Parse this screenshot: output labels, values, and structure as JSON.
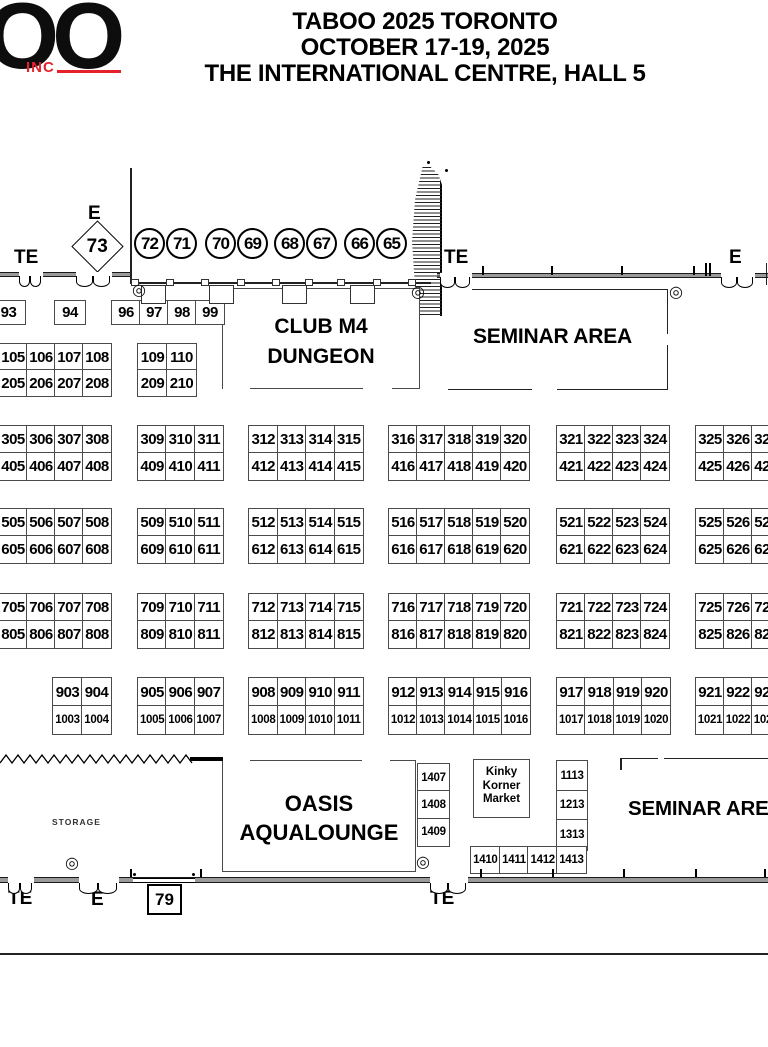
{
  "header": {
    "logo_main": "OO",
    "logo_sub": "INC",
    "title_line1": "TABOO 2025 TORONTO",
    "title_line2": "OCTOBER 17-19, 2025",
    "title_line3": "THE INTERNATIONAL CENTRE, HALL 5"
  },
  "colors": {
    "logo_red": "#e5222b",
    "wall_gray": "#9a9a9a"
  },
  "plan": {
    "entrance_labels": {
      "top_left_te": "TE",
      "top_left_e": "E",
      "top_right_te": "TE",
      "top_right_e": "E",
      "bottom_left_te": "TE",
      "bottom_e": "E",
      "bottom_right_te": "TE"
    },
    "diamond_booth": "73",
    "booth_79": "79",
    "circle_booths": [
      "72",
      "71",
      "70",
      "69",
      "68",
      "67",
      "66",
      "65"
    ],
    "areas": {
      "club_line1": "CLUB M4",
      "club_line2": "DUNGEON",
      "seminar_top": "SEMINAR AREA",
      "seminar_bottom": "SEMINAR AREA",
      "oasis_line1": "OASIS",
      "oasis_line2": "AQUALOUNGE",
      "kinky_line1": "Kinky",
      "kinky_line2": "Korner",
      "kinky_line3": "Market",
      "storage": "STORAGE"
    },
    "blocks": [
      {
        "x": -9,
        "y": 300,
        "cw": 33,
        "rh": 23,
        "rows": [
          [
            "93"
          ]
        ]
      },
      {
        "x": 54,
        "y": 300,
        "cw": 30,
        "rh": 23,
        "rows": [
          [
            "94"
          ]
        ]
      },
      {
        "x": 111,
        "y": 300,
        "cw": 28,
        "rh": 23,
        "rows": [
          [
            "96",
            "97",
            "98",
            "99"
          ]
        ]
      },
      {
        "x": -2,
        "y": 343,
        "cw": 28,
        "rh": 26,
        "rows": [
          [
            "105",
            "106",
            "107",
            "108"
          ],
          [
            "205",
            "206",
            "207",
            "208"
          ]
        ]
      },
      {
        "x": 137,
        "y": 343,
        "cw": 29,
        "rh": 26,
        "rows": [
          [
            "109",
            "110"
          ],
          [
            "209",
            "210"
          ]
        ]
      },
      {
        "x": -2,
        "y": 425,
        "cw": 28,
        "rh": 27,
        "rows": [
          [
            "305",
            "306",
            "307",
            "308"
          ],
          [
            "405",
            "406",
            "407",
            "408"
          ]
        ]
      },
      {
        "x": 137,
        "y": 425,
        "cw": 28.3,
        "rh": 27,
        "rows": [
          [
            "309",
            "310",
            "311"
          ],
          [
            "409",
            "410",
            "411"
          ]
        ]
      },
      {
        "x": 248,
        "y": 425,
        "cw": 28.5,
        "rh": 27,
        "rows": [
          [
            "312",
            "313",
            "314",
            "315"
          ],
          [
            "412",
            "413",
            "414",
            "415"
          ]
        ]
      },
      {
        "x": 388,
        "y": 425,
        "cw": 28,
        "rh": 27,
        "rows": [
          [
            "316",
            "317",
            "318",
            "319",
            "320"
          ],
          [
            "416",
            "417",
            "418",
            "419",
            "420"
          ]
        ]
      },
      {
        "x": 556,
        "y": 425,
        "cw": 28,
        "rh": 27,
        "rows": [
          [
            "321",
            "322",
            "323",
            "324"
          ],
          [
            "421",
            "422",
            "423",
            "424"
          ]
        ]
      },
      {
        "x": 695,
        "y": 425,
        "cw": 28,
        "rh": 27,
        "rows": [
          [
            "325",
            "326",
            "327"
          ],
          [
            "425",
            "426",
            "427"
          ]
        ]
      },
      {
        "x": -2,
        "y": 508,
        "cw": 28,
        "rh": 27,
        "rows": [
          [
            "505",
            "506",
            "507",
            "508"
          ],
          [
            "605",
            "606",
            "607",
            "608"
          ]
        ]
      },
      {
        "x": 137,
        "y": 508,
        "cw": 28.3,
        "rh": 27,
        "rows": [
          [
            "509",
            "510",
            "511"
          ],
          [
            "609",
            "610",
            "611"
          ]
        ]
      },
      {
        "x": 248,
        "y": 508,
        "cw": 28.5,
        "rh": 27,
        "rows": [
          [
            "512",
            "513",
            "514",
            "515"
          ],
          [
            "612",
            "613",
            "614",
            "615"
          ]
        ]
      },
      {
        "x": 388,
        "y": 508,
        "cw": 28,
        "rh": 27,
        "rows": [
          [
            "516",
            "517",
            "518",
            "519",
            "520"
          ],
          [
            "616",
            "617",
            "618",
            "619",
            "620"
          ]
        ]
      },
      {
        "x": 556,
        "y": 508,
        "cw": 28,
        "rh": 27,
        "rows": [
          [
            "521",
            "522",
            "523",
            "524"
          ],
          [
            "621",
            "622",
            "623",
            "624"
          ]
        ]
      },
      {
        "x": 695,
        "y": 508,
        "cw": 28,
        "rh": 27,
        "rows": [
          [
            "525",
            "526",
            "527"
          ],
          [
            "625",
            "626",
            "627"
          ]
        ]
      },
      {
        "x": -2,
        "y": 593,
        "cw": 28,
        "rh": 27,
        "rows": [
          [
            "705",
            "706",
            "707",
            "708"
          ],
          [
            "805",
            "806",
            "807",
            "808"
          ]
        ]
      },
      {
        "x": 137,
        "y": 593,
        "cw": 28.3,
        "rh": 27,
        "rows": [
          [
            "709",
            "710",
            "711"
          ],
          [
            "809",
            "810",
            "811"
          ]
        ]
      },
      {
        "x": 248,
        "y": 593,
        "cw": 28.5,
        "rh": 27,
        "rows": [
          [
            "712",
            "713",
            "714",
            "715"
          ],
          [
            "812",
            "813",
            "814",
            "815"
          ]
        ]
      },
      {
        "x": 388,
        "y": 593,
        "cw": 28,
        "rh": 27,
        "rows": [
          [
            "716",
            "717",
            "718",
            "719",
            "720"
          ],
          [
            "816",
            "817",
            "818",
            "819",
            "820"
          ]
        ]
      },
      {
        "x": 556,
        "y": 593,
        "cw": 28,
        "rh": 27,
        "rows": [
          [
            "721",
            "722",
            "723",
            "724"
          ],
          [
            "821",
            "822",
            "823",
            "824"
          ]
        ]
      },
      {
        "x": 695,
        "y": 593,
        "cw": 28,
        "rh": 27,
        "rows": [
          [
            "725",
            "726",
            "727"
          ],
          [
            "825",
            "826",
            "827"
          ]
        ]
      },
      {
        "x": 52,
        "y": 677,
        "cw": 29,
        "rh": 28,
        "rows": [
          [
            "903",
            "904"
          ],
          [
            "1003",
            "1004"
          ]
        ]
      },
      {
        "x": 137,
        "y": 677,
        "cw": 28.3,
        "rh": 28,
        "rows": [
          [
            "905",
            "906",
            "907"
          ],
          [
            "1005",
            "1006",
            "1007"
          ]
        ]
      },
      {
        "x": 248,
        "y": 677,
        "cw": 28.5,
        "rh": 28,
        "rows": [
          [
            "908",
            "909",
            "910",
            "911"
          ],
          [
            "1008",
            "1009",
            "1010",
            "1011"
          ]
        ]
      },
      {
        "x": 388,
        "y": 677,
        "cw": 28.2,
        "rh": 28,
        "rows": [
          [
            "912",
            "913",
            "914",
            "915",
            "916"
          ],
          [
            "1012",
            "1013",
            "1014",
            "1015",
            "1016"
          ]
        ]
      },
      {
        "x": 556,
        "y": 677,
        "cw": 28.3,
        "rh": 28,
        "rows": [
          [
            "917",
            "918",
            "919",
            "920"
          ],
          [
            "1017",
            "1018",
            "1019",
            "1020"
          ]
        ]
      },
      {
        "x": 695,
        "y": 677,
        "cw": 28,
        "rh": 28,
        "rows": [
          [
            "921",
            "922",
            "923"
          ],
          [
            "1021",
            "1022",
            "1023"
          ]
        ]
      },
      {
        "x": 417,
        "y": 763,
        "cw": 31,
        "rh": 27.3,
        "rows": [
          [
            "1407"
          ],
          [
            "1408"
          ],
          [
            "1409"
          ]
        ]
      },
      {
        "x": 556,
        "y": 760,
        "cw": 30,
        "rh": 29.5,
        "rows": [
          [
            "1113"
          ],
          [
            "1213"
          ],
          [
            "1313"
          ]
        ]
      },
      {
        "x": 470,
        "y": 846,
        "cw": 28.7,
        "rh": 26,
        "rows": [
          [
            "1410",
            "1411",
            "1412",
            "1413"
          ]
        ]
      }
    ]
  }
}
